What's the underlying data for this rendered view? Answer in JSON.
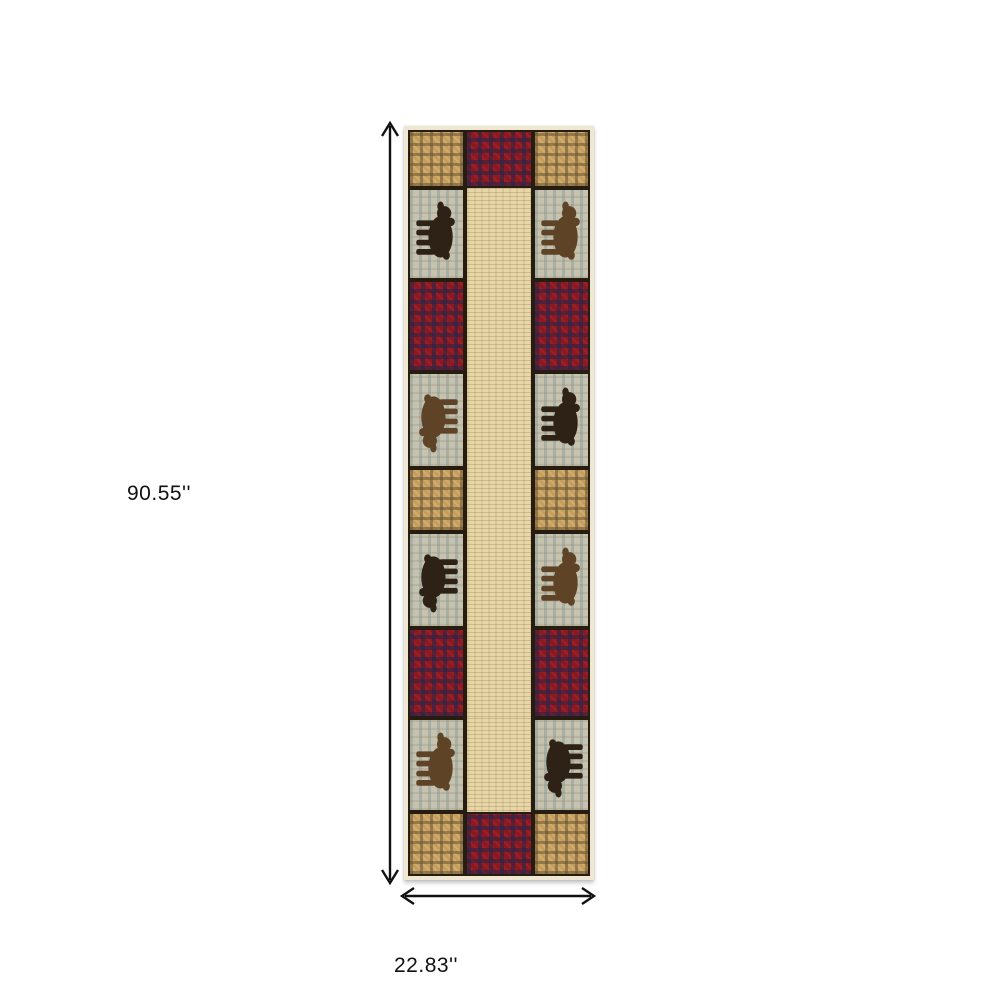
{
  "page": {
    "background_color": "#ffffff",
    "content": "product dimension diagram of a lodge-style runner rug"
  },
  "dimensions": {
    "height_label": "90.55''",
    "width_label": "22.83''",
    "arrow_color": "#111111",
    "label_color": "#111111"
  },
  "rug": {
    "description": "rustic lodge patchwork runner rug with bear motifs, tan gingham plaid squares, red buffalo-check squares and a continuous beige centre strip",
    "palette": {
      "border_cream": "#f0e7d2",
      "frame_dark": "#261c10",
      "plaid_tan_base": "#c59e5e",
      "plaid_tan_dark": "#685332",
      "check_red_base": "#8c1820",
      "check_red_navy": "#2c2547",
      "beige_base": "#e6d6a8",
      "beige_line": "#947542",
      "bear_background": "#c6c2b0",
      "bear_background_streak": "#7e9494",
      "bear_dark": "#2e2116",
      "bear_brown": "#5f4326"
    },
    "rows": [
      {
        "h": 58,
        "left": "plaid",
        "center": "red",
        "right": "plaid"
      },
      {
        "h": 92,
        "left": "bear dark up",
        "center": "beige",
        "right": "bear brown up"
      },
      {
        "h": 92,
        "left": "red",
        "center": "beige",
        "right": "red"
      },
      {
        "h": 96,
        "left": "bear brown down",
        "center": "beige",
        "right": "bear dark up"
      },
      {
        "h": 64,
        "left": "plaid",
        "center": "beige",
        "right": "plaid"
      },
      {
        "h": 96,
        "left": "bear dark down",
        "center": "beige",
        "right": "bear brown up"
      },
      {
        "h": 90,
        "left": "red",
        "center": "beige",
        "right": "red"
      },
      {
        "h": 94,
        "left": "bear brown up",
        "center": "beige",
        "right": "bear dark down"
      },
      {
        "h": 64,
        "left": "plaid",
        "center": "red",
        "right": "plaid"
      }
    ]
  }
}
